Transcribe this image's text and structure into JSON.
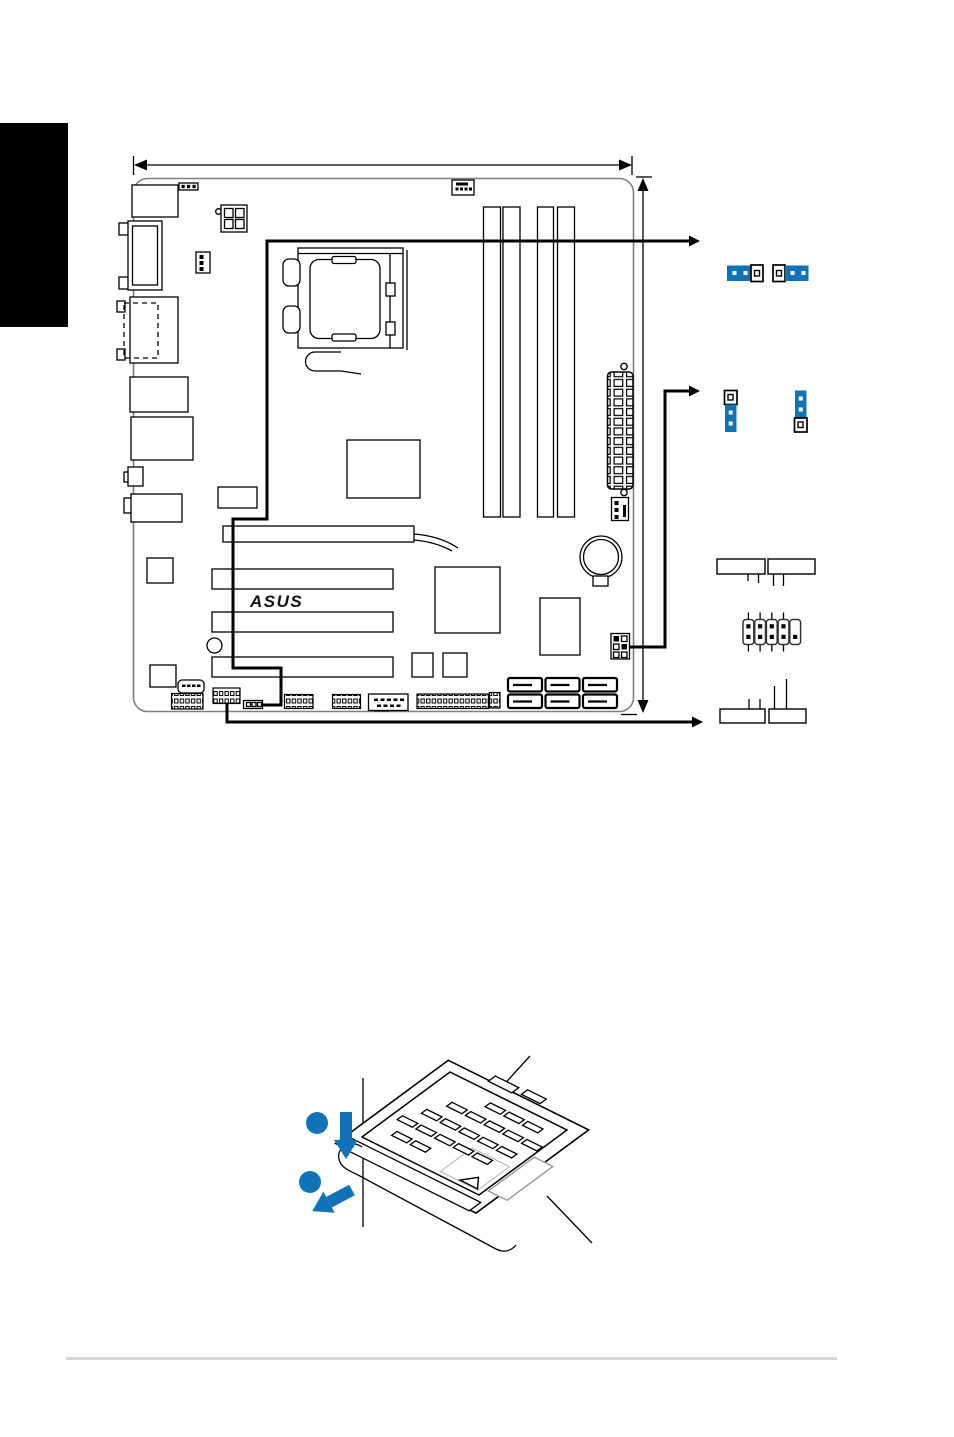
{
  "page": {
    "background": "#ffffff",
    "side_tab_color": "#000000",
    "footer_rule_color": "#d6d6d6"
  },
  "colors": {
    "accent_blue": "#1073b8",
    "diagram_line": "#000000",
    "board_outline": "#7f7f7f",
    "gray_detail": "#a9a9a9"
  },
  "board": {
    "logo_text": "ASUS",
    "dimm_slots": 4,
    "pci_slots": 3,
    "pcie_x16_slots": 1,
    "sata_ports": 6,
    "atx_power_pins": 24
  },
  "jumper_figures": {
    "horizontal_pair": [
      {
        "state": "pins 1-2 capped, pin 3 open"
      },
      {
        "state": "pin 1 open, pins 2-3 capped"
      }
    ],
    "vertical_pair": [
      {
        "state": "pin 1 open, pins 2-3 capped"
      },
      {
        "state": "pins 1-2 capped, pin 3 open"
      }
    ],
    "panel_connector_plugs": 5
  },
  "socket_figure": {
    "step_badges": 2
  }
}
